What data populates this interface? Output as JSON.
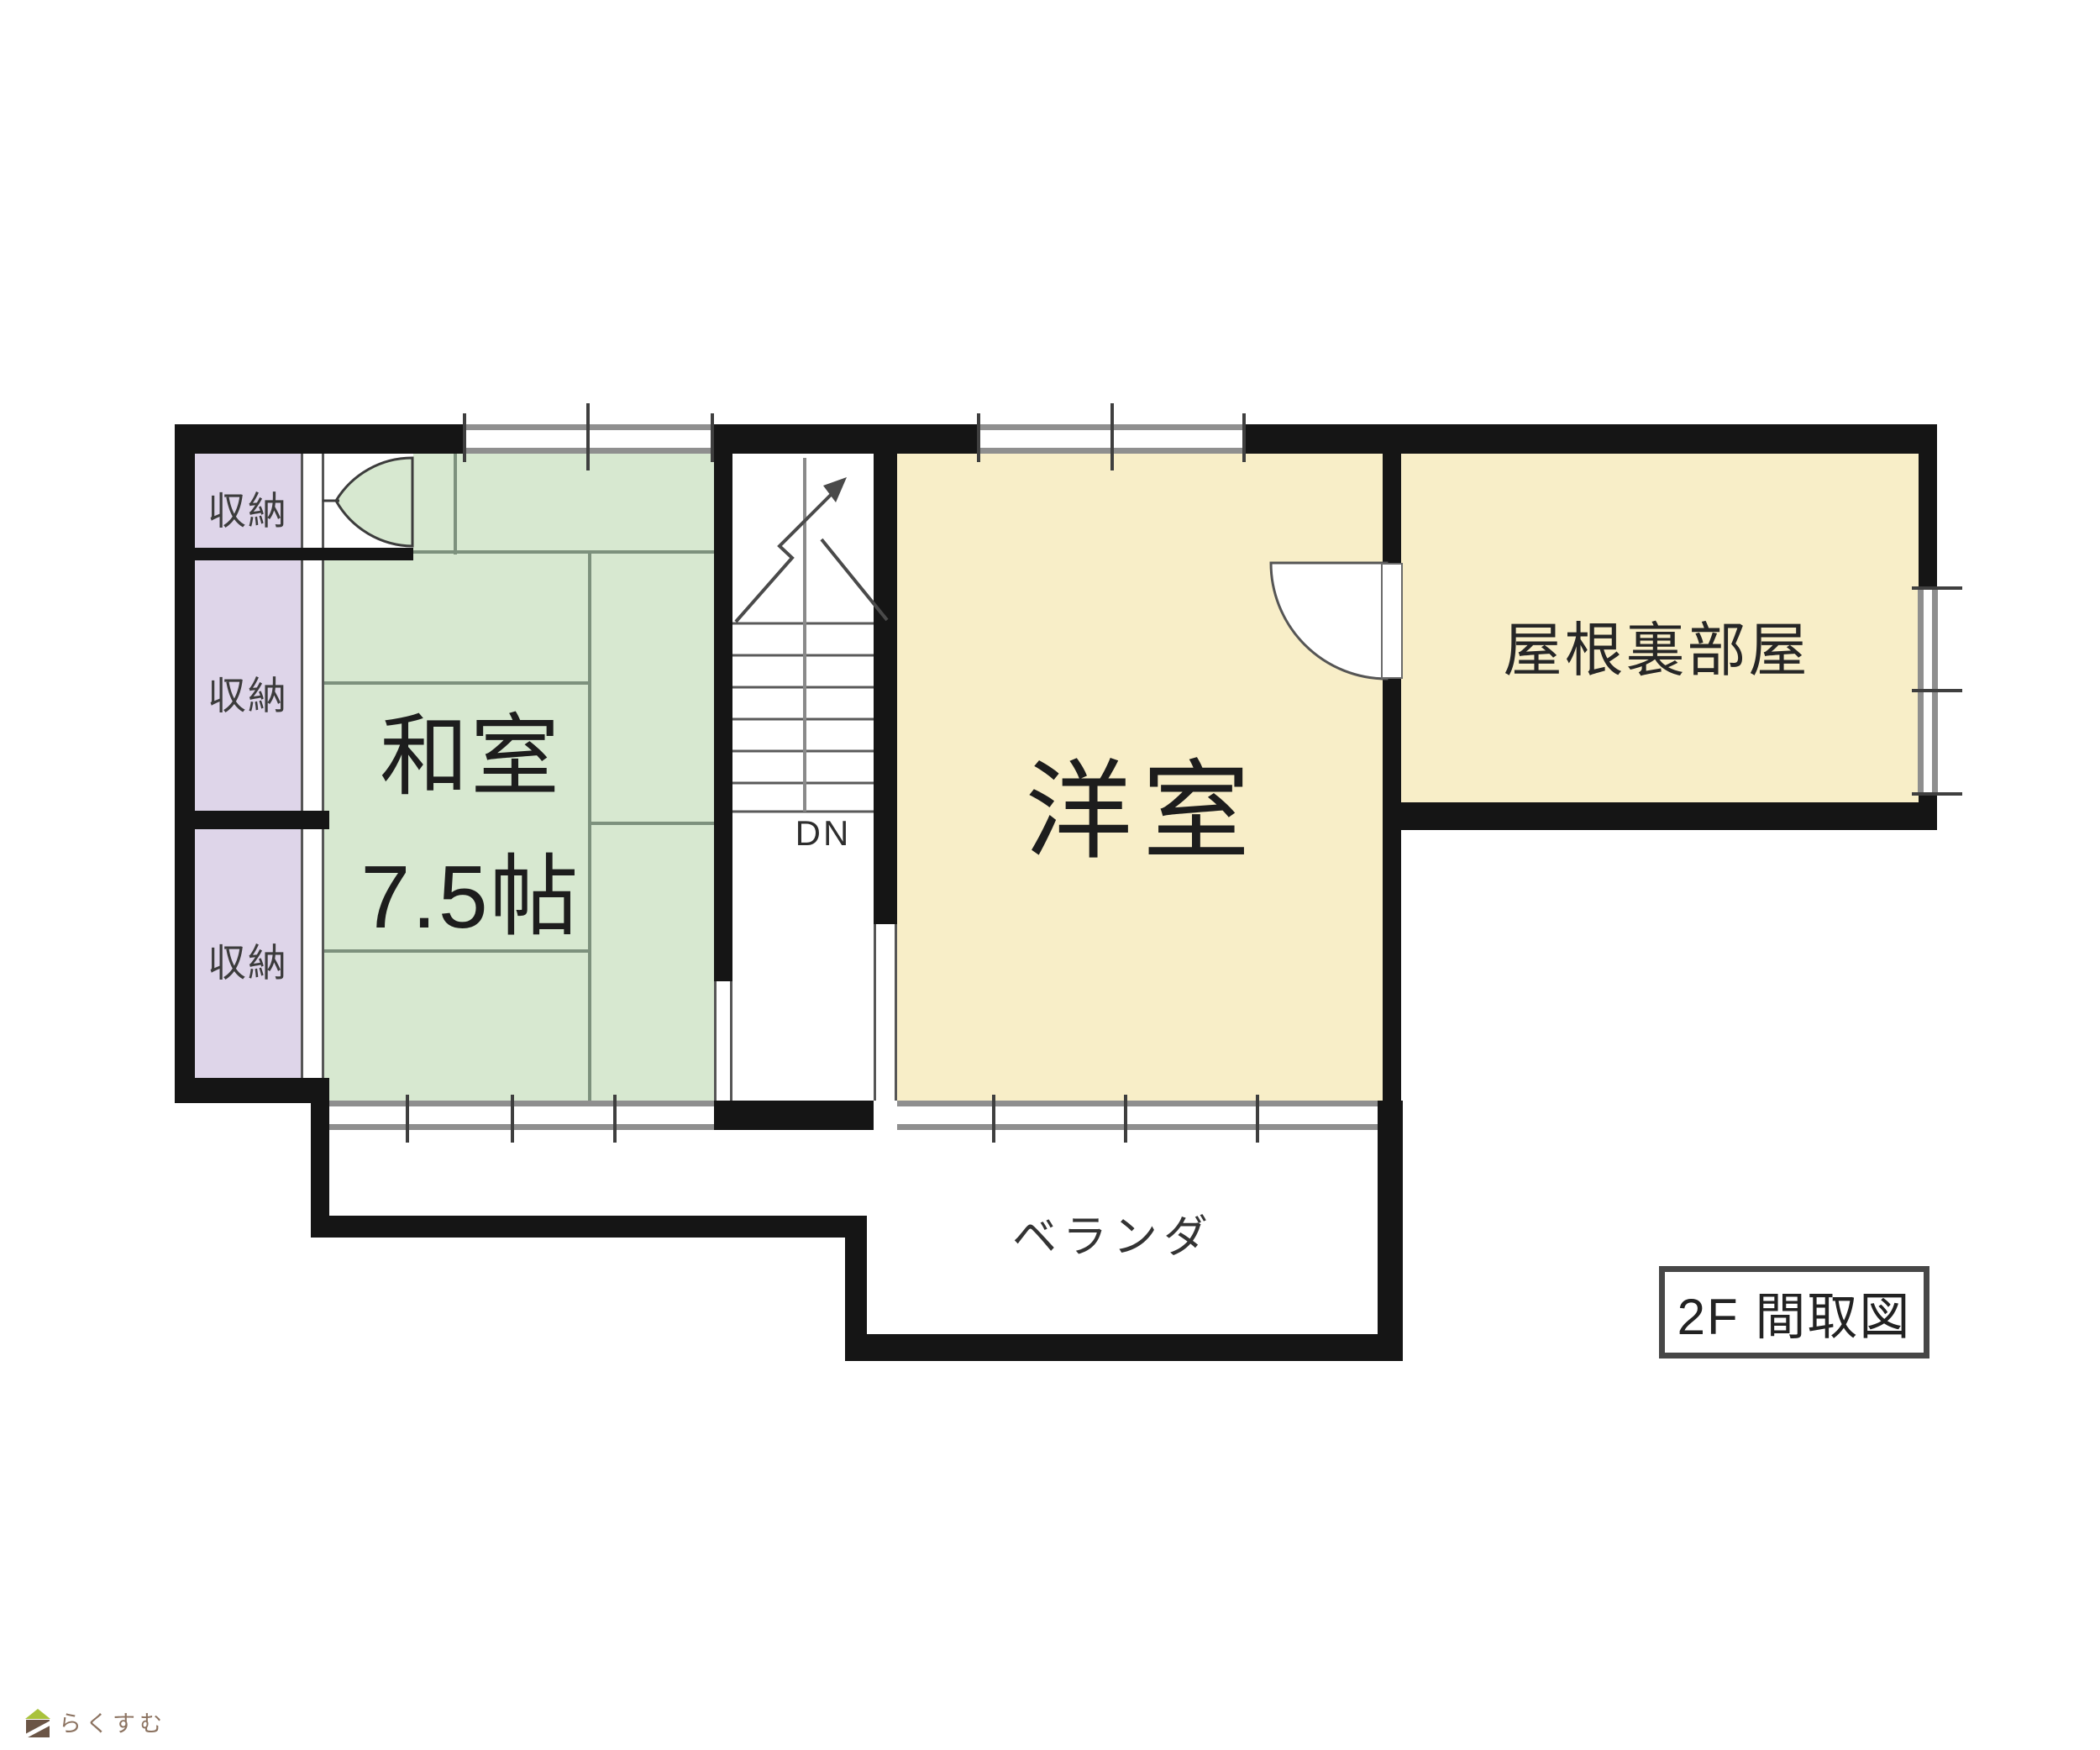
{
  "plan": {
    "title": "2F 間取図",
    "rooms": {
      "washitsu": {
        "name": "和室",
        "size": "7.5帖"
      },
      "western_room": {
        "name": "洋室"
      },
      "attic": {
        "name": "屋根裏部屋"
      },
      "veranda": {
        "name": "ベランダ"
      },
      "storage": {
        "label": "収納"
      },
      "stairs": {
        "direction_label": "DN"
      }
    },
    "colors": {
      "wall": "#151515",
      "tatami_green": "#d7e8d0",
      "tatami_line": "#7d917d",
      "storage_purple": "#ded5e9",
      "room_cream": "#f8eec8",
      "window_gray": "#8f8f8f",
      "text_dark": "#2b2b2b"
    },
    "watermark": {
      "text": "らくすむ"
    }
  }
}
